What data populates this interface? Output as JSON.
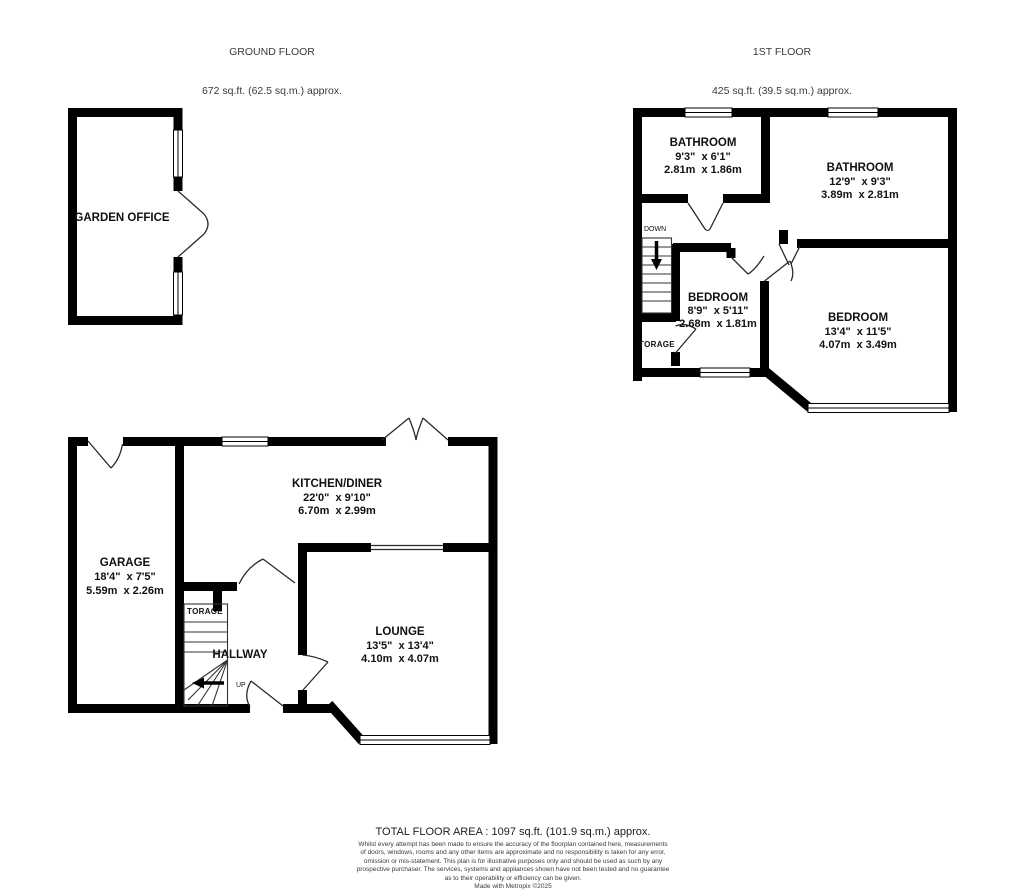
{
  "colors": {
    "wall": "#000000",
    "text": "#111111",
    "background": "#ffffff"
  },
  "floors": {
    "ground": {
      "title": "GROUND FLOOR",
      "subtitle": "672 sq.ft. (62.5 sq.m.) approx.",
      "rooms": {
        "garden_office": {
          "name": "GARDEN OFFICE"
        },
        "kitchen_diner": {
          "name": "KITCHEN/DINER",
          "imperial": "22'0\"  x 9'10\"",
          "metric": "6.70m  x 2.99m"
        },
        "garage": {
          "name": "GARAGE",
          "imperial": "18'4\"  x 7'5\"",
          "metric": "5.59m  x 2.26m"
        },
        "lounge": {
          "name": "LOUNGE",
          "imperial": "13'5\"  x 13'4\"",
          "metric": "4.10m  x 4.07m"
        },
        "hallway": {
          "name": "HALLWAY"
        },
        "storage": {
          "name": "TORAGE"
        }
      },
      "stairs_label": "UP"
    },
    "first": {
      "title": "1ST FLOOR",
      "subtitle": "425 sq.ft. (39.5 sq.m.) approx.",
      "rooms": {
        "bathroom_small": {
          "name": "BATHROOM",
          "imperial": "9'3\"  x 6'1\"",
          "metric": "2.81m  x 1.86m"
        },
        "bathroom_large": {
          "name": "BATHROOM",
          "imperial": "12'9\"  x 9'3\"",
          "metric": "3.89m  x 2.81m"
        },
        "bedroom_small": {
          "name": "BEDROOM",
          "imperial": "8'9\"  x 5'11\"",
          "metric": "2.68m  x 1.81m"
        },
        "bedroom_large": {
          "name": "BEDROOM",
          "imperial": "13'4\"  x 11'5\"",
          "metric": "4.07m  x 3.49m"
        },
        "storage": {
          "name": "TORAGE"
        }
      },
      "stairs_label": "DOWN"
    }
  },
  "footer": {
    "total_area": "TOTAL FLOOR AREA : 1097 sq.ft. (101.9 sq.m.) approx.",
    "disclaimer_lines": [
      "Whilst every attempt has been made to ensure the accuracy of the floorplan contained here, measurements",
      "of doors, windows, rooms and any other items are approximate and no responsibility is taken for any error,",
      "omission or mis-statement. This plan is for illustrative purposes only and should be used as such by any",
      "prospective purchaser. The services, systems and appliances shown have not been tested and no guarantee",
      "as to their operability or efficiency can be given.",
      "Made with Metropix ©2025"
    ]
  }
}
